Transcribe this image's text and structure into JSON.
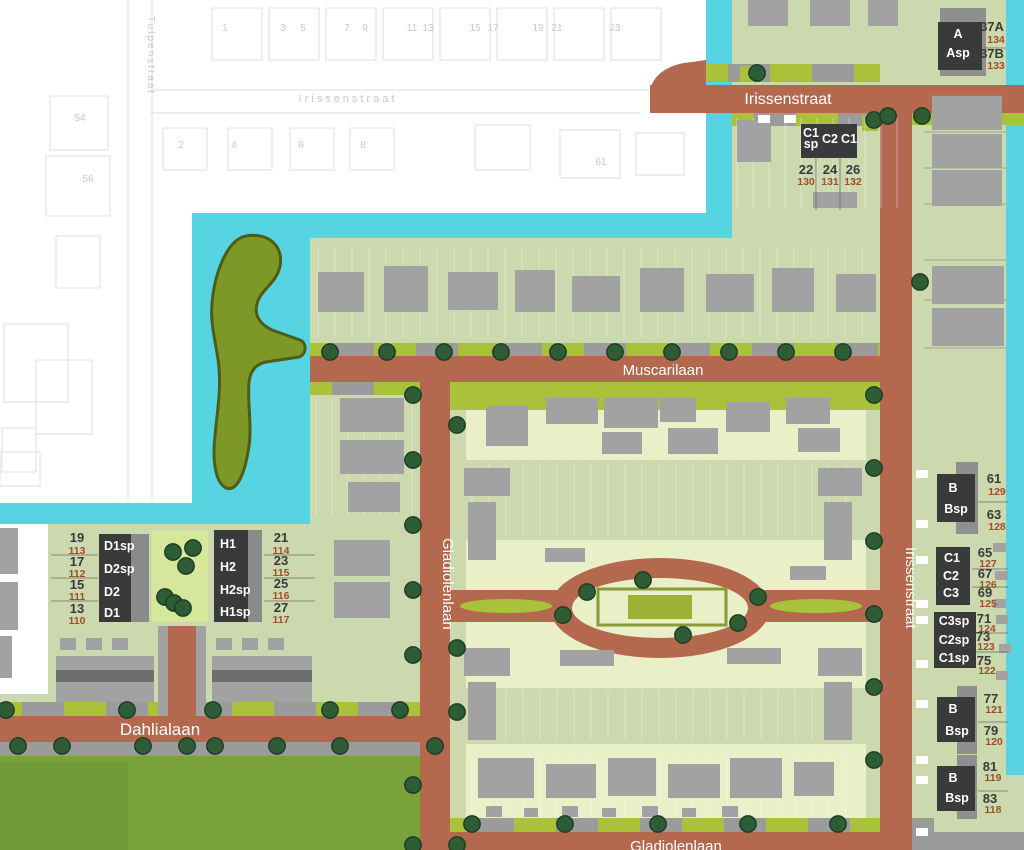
{
  "colors": {
    "base": "#ccd8ad",
    "white": "#ffffff",
    "water": "#57d4e2",
    "road": "#b4684e",
    "pale": "#e9efc6",
    "park": "#d6e69b",
    "grass": "#7aa23b",
    "grass2": "#6f9a38",
    "island": "#7d9827",
    "islandStroke": "#4e5c16",
    "verge": "#a9c23a",
    "strip": "#9b9b9b",
    "bld": "#a2a2a2",
    "bldDark": "#6e6e6e",
    "backing": "#8f8f8f",
    "box": "#3a3a3a",
    "boxLight": "#8a8a8a",
    "tree": "#2d5c35",
    "treeStroke": "#1c3c24",
    "no": "#3a3a3a",
    "id": "#a14e2a",
    "faintText": "#c8c8c8",
    "outline": "#dedede",
    "frame": "#8a9a3a",
    "centerFill": "#9cb236"
  },
  "streets": {
    "irissenstraat_top": "Irissenstraat",
    "irissenstraat_right": "Irissenstraat",
    "muscarilaan": "Muscarilaan",
    "gladiolenlaan_left": "Gladiolenlaan",
    "gladiolenlaan_bottom": "Gladiolenlaan",
    "dahlialaan": "Dahlialaan"
  },
  "existing": {
    "street_h": "Irissenstraat",
    "street_v": "Tulpenstraat",
    "row1": [
      "1",
      "3",
      "5",
      "7",
      "9",
      "11",
      "13",
      "15",
      "17",
      "19",
      "21",
      "23"
    ],
    "row2": [
      "2",
      "4",
      "6",
      "8"
    ],
    "side": [
      "54",
      "56"
    ],
    "extra": "61"
  },
  "blocks": {
    "a": {
      "types": [
        "A",
        "Asp"
      ],
      "lots": [
        [
          "37A",
          "134"
        ],
        [
          "37B",
          "133"
        ]
      ]
    },
    "cn": {
      "types": [
        "C1\nsp",
        "C2",
        "C1"
      ],
      "lots": [
        [
          "22",
          "130"
        ],
        [
          "24",
          "131"
        ],
        [
          "26",
          "132"
        ]
      ]
    },
    "b1": {
      "types": [
        "B",
        "Bsp"
      ],
      "lots": [
        [
          "61",
          "129"
        ],
        [
          "63",
          "128"
        ]
      ]
    },
    "cm": {
      "types": [
        "C1",
        "C2",
        "C3"
      ],
      "lots": [
        [
          "65",
          "127"
        ],
        [
          "67",
          "126"
        ],
        [
          "69",
          "125"
        ]
      ]
    },
    "csp": {
      "types": [
        "C3sp",
        "C2sp",
        "C1sp"
      ],
      "lots": [
        [
          "71",
          "124"
        ],
        [
          "73",
          "123"
        ],
        [
          "75",
          "122"
        ]
      ]
    },
    "b2": {
      "types": [
        "B",
        "Bsp"
      ],
      "lots": [
        [
          "77",
          "121"
        ],
        [
          "79",
          "120"
        ]
      ]
    },
    "b3": {
      "types": [
        "B",
        "Bsp"
      ],
      "lots": [
        [
          "81",
          "119"
        ],
        [
          "83",
          "118"
        ]
      ]
    },
    "d": {
      "types": [
        "D1sp",
        "D2sp",
        "D2",
        "D1"
      ],
      "lots": [
        [
          "19",
          "113"
        ],
        [
          "17",
          "112"
        ],
        [
          "15",
          "111"
        ],
        [
          "13",
          "110"
        ]
      ]
    },
    "h": {
      "types": [
        "H1",
        "H2",
        "H2sp",
        "H1sp"
      ],
      "lots": [
        [
          "21",
          "114"
        ],
        [
          "23",
          "115"
        ],
        [
          "25",
          "116"
        ],
        [
          "27",
          "117"
        ]
      ]
    }
  }
}
